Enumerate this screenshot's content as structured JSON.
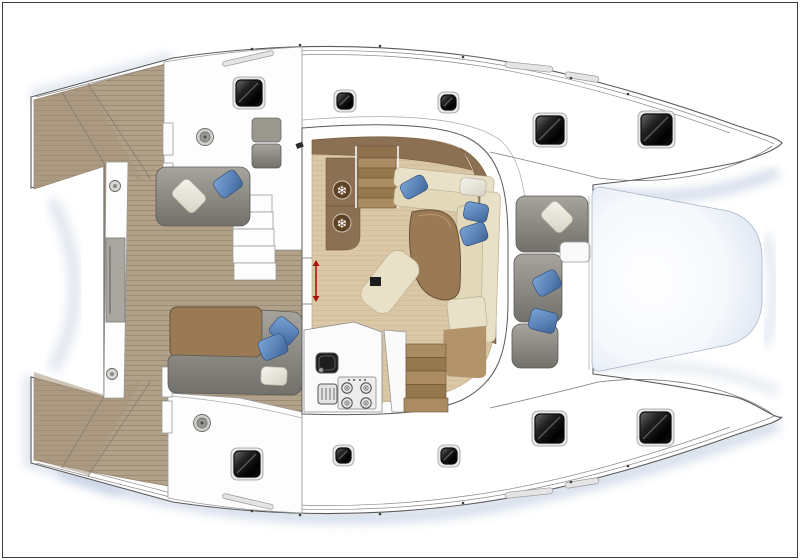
{
  "meta": {
    "title": "Catamaran deck and saloon floor plan — top view, bows to the right",
    "drawing_type": "boat-floor-plan"
  },
  "palette": {
    "line": "#5a5a5a",
    "railLine": "#8a8a8a",
    "teak": "#b2a189",
    "teakDark": "#a5947c",
    "teakLine": "#95846c",
    "floorWood": "#dac7a6",
    "woodDark": "#8c7053",
    "woodTable": "#9a7a54",
    "cream": "#e9e0c8",
    "creamEdge": "#bdb091",
    "graySofa": "#8b8983",
    "pillowBlue": "#5d86bb",
    "pillowWhite": "#eae7dd",
    "hatchDark": "#141414",
    "trampoline": "#eef2f8",
    "shadow": "#9fb2d0",
    "red": "#a8170f",
    "background": "#ffffff"
  },
  "counts": {
    "deck_hatches": 10,
    "pillows_blue": 8,
    "pillows_white": 4,
    "fridge_drawers": 2,
    "stove_burners": 4,
    "winches": 2,
    "stair_flights": 2
  },
  "hatches": {
    "top_hull": [
      {
        "x": 236,
        "y": 80,
        "s": 26
      },
      {
        "x": 337,
        "y": 93,
        "s": 16
      },
      {
        "x": 441,
        "y": 95,
        "s": 15
      },
      {
        "x": 536,
        "y": 116,
        "s": 28
      },
      {
        "x": 641,
        "y": 114,
        "s": 31
      }
    ],
    "bottom_hull": [
      {
        "x": 234,
        "y": 451,
        "s": 26
      },
      {
        "x": 336,
        "y": 448,
        "s": 15
      },
      {
        "x": 441,
        "y": 448,
        "s": 16
      },
      {
        "x": 535,
        "y": 414,
        "s": 29
      },
      {
        "x": 640,
        "y": 412,
        "s": 31
      }
    ]
  },
  "pillows": [
    {
      "cx": 189,
      "cy": 196,
      "w": 30,
      "h": 23,
      "rot": 45,
      "color": "white",
      "area": "aft-lounge"
    },
    {
      "cx": 228,
      "cy": 184,
      "w": 26,
      "h": 20,
      "rot": -35,
      "color": "blue",
      "area": "aft-lounge"
    },
    {
      "cx": 284,
      "cy": 331,
      "w": 26,
      "h": 21,
      "rot": 40,
      "color": "blue",
      "area": "aft-dinette"
    },
    {
      "cx": 273,
      "cy": 347,
      "w": 27,
      "h": 21,
      "rot": -22,
      "color": "blue",
      "area": "aft-dinette"
    },
    {
      "cx": 274,
      "cy": 376,
      "w": 26,
      "h": 18,
      "rot": 3,
      "color": "white",
      "area": "aft-dinette"
    },
    {
      "cx": 414,
      "cy": 187,
      "w": 26,
      "h": 17,
      "rot": -28,
      "color": "blue",
      "area": "saloon"
    },
    {
      "cx": 473,
      "cy": 187,
      "w": 26,
      "h": 17,
      "rot": 6,
      "color": "white",
      "area": "saloon"
    },
    {
      "cx": 476,
      "cy": 212,
      "w": 24,
      "h": 18,
      "rot": 12,
      "color": "blue",
      "area": "saloon"
    },
    {
      "cx": 474,
      "cy": 234,
      "w": 26,
      "h": 19,
      "rot": -18,
      "color": "blue",
      "area": "saloon"
    },
    {
      "cx": 557,
      "cy": 217,
      "w": 28,
      "h": 22,
      "rot": 45,
      "color": "white",
      "area": "forward-cockpit"
    },
    {
      "cx": 547,
      "cy": 283,
      "w": 26,
      "h": 20,
      "rot": -28,
      "color": "blue",
      "area": "forward-cockpit"
    },
    {
      "cx": 543,
      "cy": 321,
      "w": 27,
      "h": 21,
      "rot": 14,
      "color": "blue",
      "area": "forward-cockpit"
    }
  ],
  "icons": {
    "fridge_snowflakes": {
      "glyph": "❄",
      "positions": [
        {
          "cx": 342,
          "cy": 190
        },
        {
          "cx": 342,
          "cy": 223
        }
      ]
    },
    "stove": {
      "burners": [
        {
          "cx": 347,
          "cy": 388
        },
        {
          "cx": 366,
          "cy": 388
        },
        {
          "cx": 347,
          "cy": 403
        },
        {
          "cx": 366,
          "cy": 403
        }
      ],
      "knobs": [
        {
          "cx": 349,
          "cy": 380
        },
        {
          "cx": 354,
          "cy": 380
        },
        {
          "cx": 360,
          "cy": 380
        },
        {
          "cx": 365,
          "cy": 380
        }
      ]
    },
    "winches": [
      {
        "cx": 205,
        "cy": 137
      },
      {
        "cx": 202,
        "cy": 423
      }
    ],
    "beam_fittings": [
      {
        "cx": 115,
        "cy": 186
      },
      {
        "cx": 112,
        "cy": 374
      }
    ],
    "door_arrow": {
      "x": 316,
      "y1": 266,
      "y2": 296
    }
  },
  "rail_fittings": {
    "top": [
      {
        "cx": 252,
        "cy": 49
      },
      {
        "cx": 300,
        "cy": 45
      },
      {
        "cx": 380,
        "cy": 46
      },
      {
        "cx": 463,
        "cy": 57
      },
      {
        "cx": 571,
        "cy": 78
      },
      {
        "cx": 628,
        "cy": 94
      }
    ],
    "bottom": [
      {
        "cx": 252,
        "cy": 511
      },
      {
        "cx": 300,
        "cy": 515
      },
      {
        "cx": 380,
        "cy": 514
      },
      {
        "cx": 463,
        "cy": 503
      },
      {
        "cx": 571,
        "cy": 482
      },
      {
        "cx": 628,
        "cy": 466
      }
    ]
  }
}
